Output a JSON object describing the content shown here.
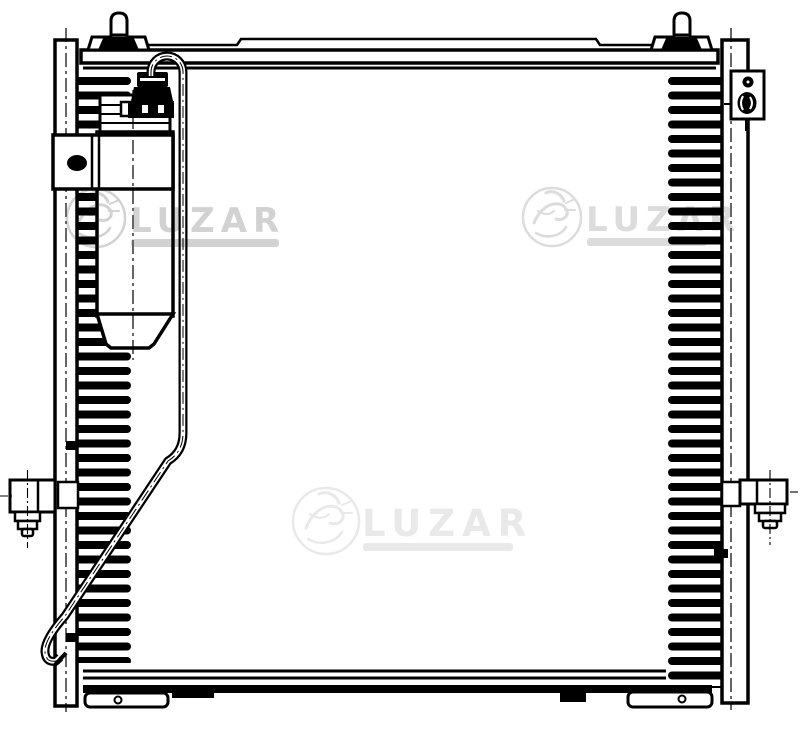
{
  "watermarks": [
    {
      "text": "LUZAR"
    },
    {
      "text": "LUZAR"
    },
    {
      "text": "LUZAR"
    }
  ],
  "colors": {
    "line": "#000000",
    "background": "#ffffff",
    "watermark_left": "#d2d2d2",
    "watermark_right": "#dcdcdc",
    "watermark_center": "#e9e9e9"
  }
}
